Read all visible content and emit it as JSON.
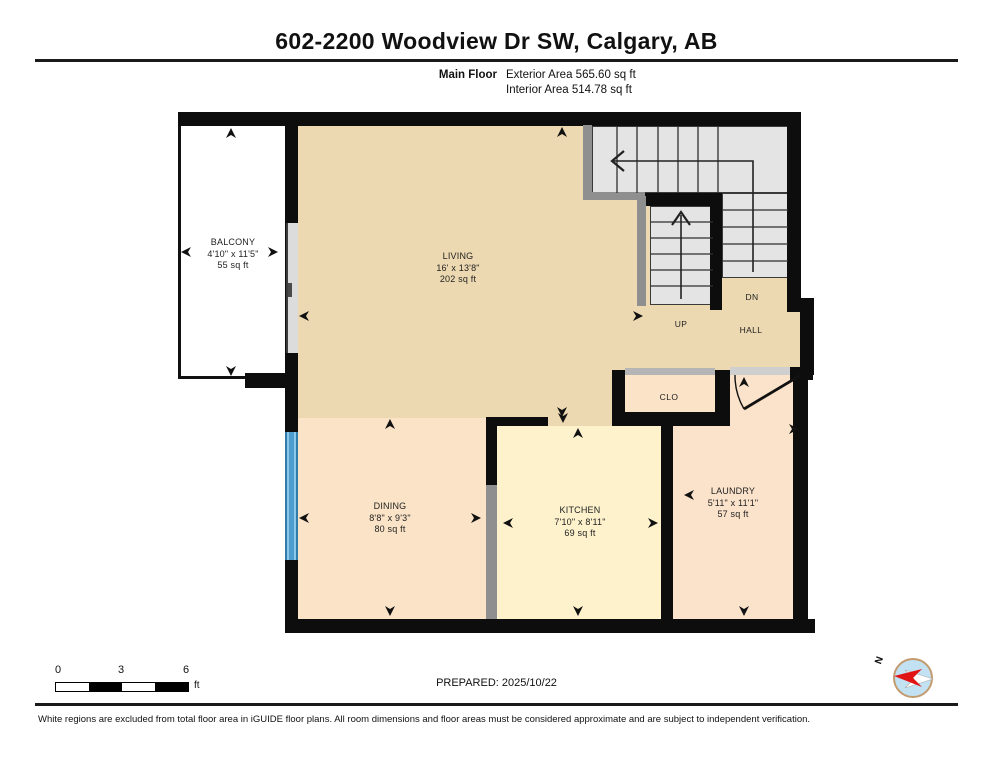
{
  "title": "602-2200 Woodview Dr SW, Calgary, AB",
  "floor": {
    "name": "Main Floor",
    "exterior": "Exterior Area 565.60 sq ft",
    "interior": "Interior Area 514.78 sq ft"
  },
  "rooms": {
    "balcony": {
      "name": "BALCONY",
      "dims": "4'10\" x 11'5\"",
      "area": "55 sq ft"
    },
    "living": {
      "name": "LIVING",
      "dims": "16' x 13'8\"",
      "area": "202 sq ft"
    },
    "dining": {
      "name": "DINING",
      "dims": "8'8\" x 9'3\"",
      "area": "80 sq ft"
    },
    "kitchen": {
      "name": "KITCHEN",
      "dims": "7'10\" x 8'11\"",
      "area": "69 sq ft"
    },
    "laundry": {
      "name": "LAUNDRY",
      "dims": "5'11\" x 11'1\"",
      "area": "57 sq ft"
    },
    "closet": {
      "name": "CLO"
    }
  },
  "stairs": {
    "up": "UP",
    "down": "DN",
    "hall": "HALL"
  },
  "scale_bar": {
    "ticks": [
      "0",
      "3",
      "6"
    ],
    "unit": "ft"
  },
  "compass": {
    "north": "N"
  },
  "prepared": "PREPARED: 2025/10/22",
  "disclaimer": "White regions are excluded from total floor area in iGUIDE floor plans. All room dimensions and floor areas must be considered approximate and are subject to independent verification.",
  "colors": {
    "living": "#ecd9b1",
    "dining": "#fae3c6",
    "kitchen": "#fdf2cc",
    "laundry": "#fbe2ca",
    "stairs": "#e4e4e4",
    "wall": "#0d0d0d",
    "window": "#4d9dcf",
    "north_red": "#e01414"
  }
}
